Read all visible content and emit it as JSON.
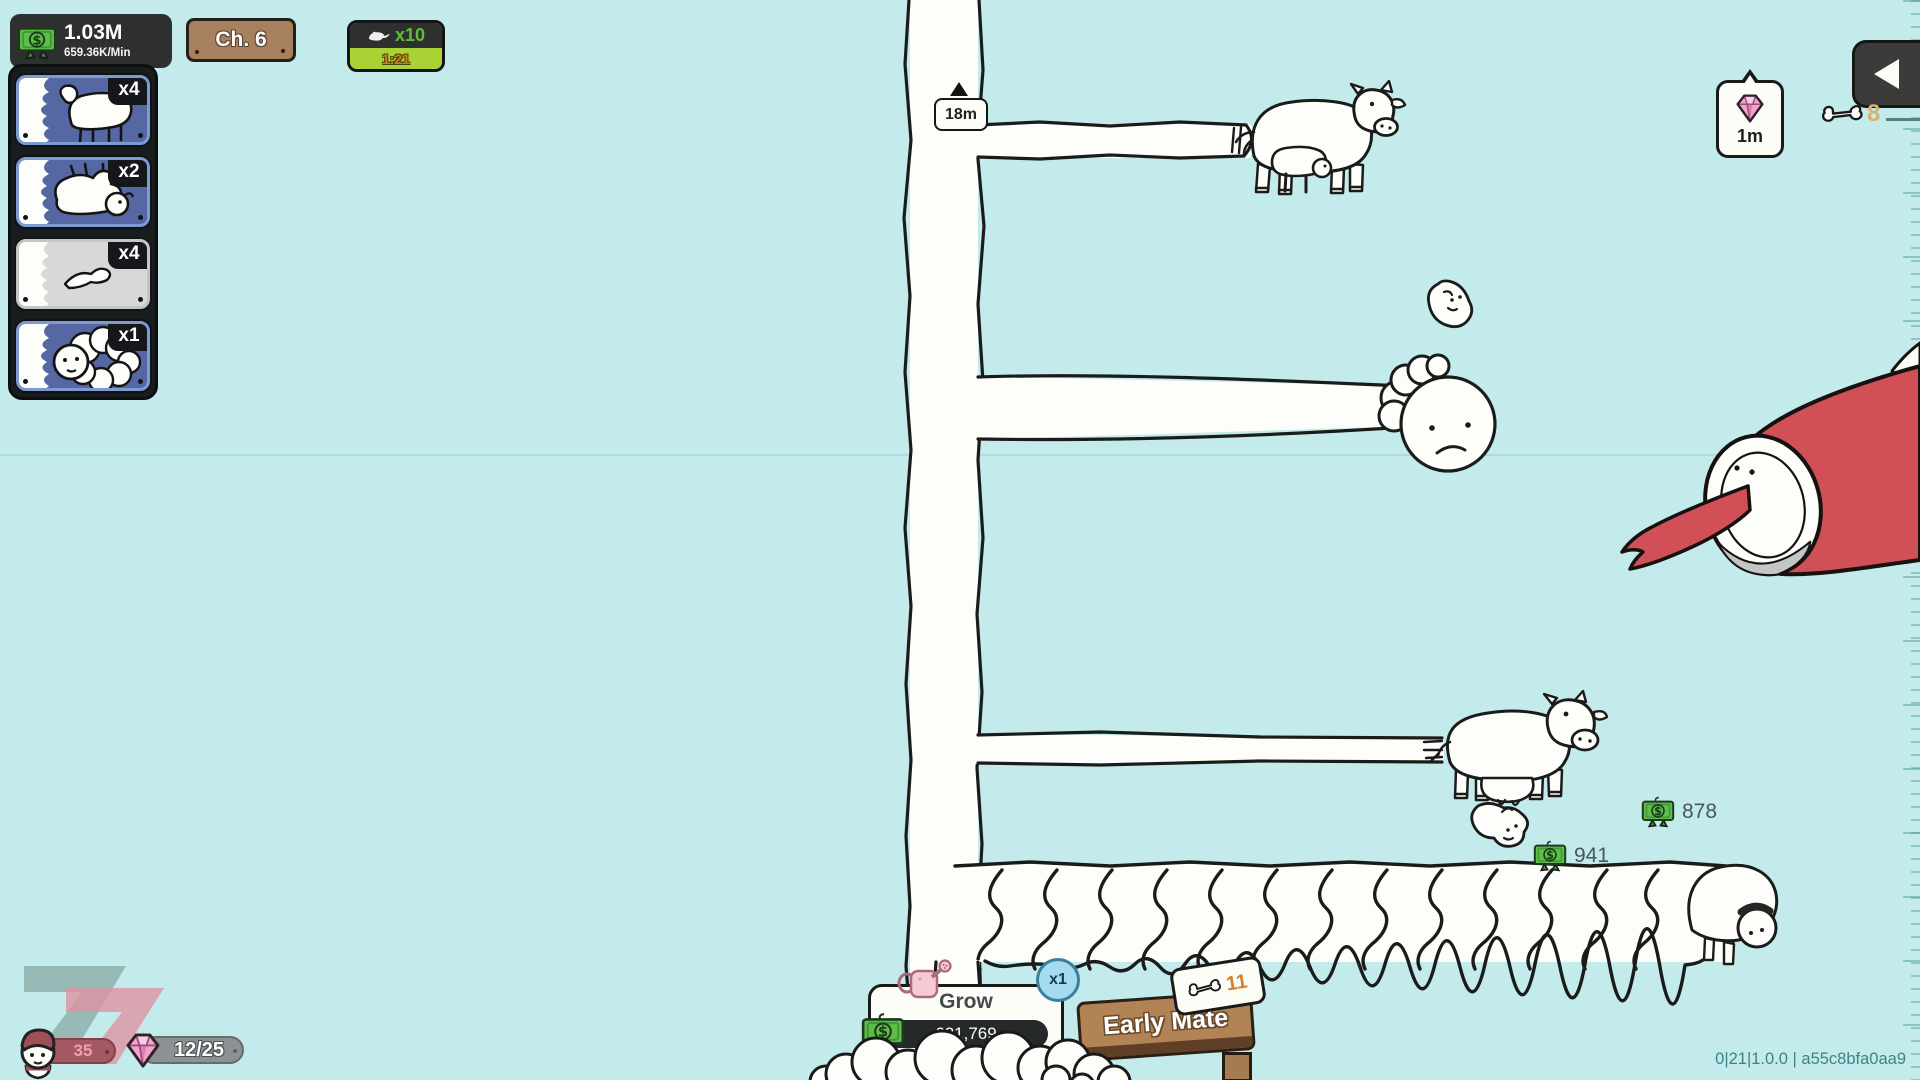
{
  "colors": {
    "background": "#c3ebeb",
    "dark_panel": "#2d302f",
    "accent_green": "#5cc132",
    "boost_green": "#a9d335",
    "timer_orange": "#cf7f1d",
    "wood": "#a6805f",
    "card_blue": "#5668a3",
    "card_gray": "#d7d8d8",
    "money_green": "#5fbe49",
    "gem_pink": "#f0a6cb",
    "creature_red": "#d14f57",
    "badge_blue": "#a4dbef",
    "bone_tan": "#d8b269"
  },
  "hud": {
    "money": {
      "value": "1.03M",
      "rate": "659.36K/Min",
      "icon": "money-icon"
    },
    "chapter": {
      "label": "Ch. 6"
    },
    "boost": {
      "multiplier": "x10",
      "timer": "1:21",
      "icon": "rat-icon"
    },
    "gem_drop": {
      "label": "1m",
      "icon": "gem-icon"
    },
    "bones": {
      "count": "8",
      "icon": "bone-icon"
    },
    "back": {
      "icon": "back-arrow-icon"
    }
  },
  "sidebar": {
    "cards": [
      {
        "multiplier": "x4",
        "style": "blue",
        "art": "sheep-standing"
      },
      {
        "multiplier": "x2",
        "style": "blue",
        "art": "sheep-on-back"
      },
      {
        "multiplier": "x4",
        "style": "gray",
        "art": "leg-doodle"
      },
      {
        "multiplier": "x1",
        "style": "blue",
        "art": "wool-head"
      }
    ]
  },
  "world": {
    "height_marker": {
      "label": "18m"
    },
    "money_drops": [
      {
        "value": "878"
      },
      {
        "value": "941"
      }
    ]
  },
  "footer": {
    "grow": {
      "label": "Grow",
      "progress": "621,769",
      "badge": "x1",
      "icon": "watering-can-icon"
    },
    "sign": {
      "label": "Early Mate",
      "cost": "11",
      "icon": "bone-icon"
    },
    "level": {
      "value": "35"
    },
    "gems": {
      "value": "12/25"
    },
    "version": "0|21|1.0.0 | a55c8bfa0aa9"
  }
}
